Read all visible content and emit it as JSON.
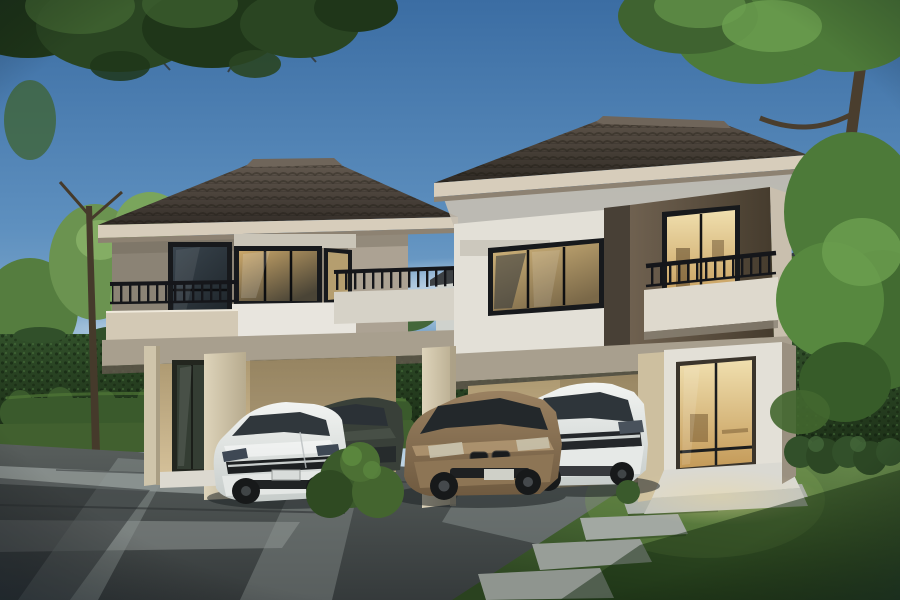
{
  "scene": {
    "type": "architectural-rendering",
    "description": "Dusk 3D rendering of a pair of modern two-storey townhouses with dark tiled hip roofs and warm lit interiors; four cars are parked under the carports; clipped hedge walls, lawn with stepping stones and a paved driveway in front; overhanging tree canopies frame the top corners",
    "time_of_day": "dusk",
    "houses": [
      {
        "name": "left-house",
        "storeys": 2,
        "roof": "hip roof, dark brown tiles, cream fascia",
        "walls": "taupe upper walls with white spandrel band, beige carport wall",
        "features": [
          "tall dark corner window",
          "lit corner window",
          "black metal balcony railing",
          "cream balcony base",
          "carport with cream pillars",
          "ground-floor glass door"
        ]
      },
      {
        "name": "right-house",
        "storeys": 2,
        "roof": "hip roof, dark brown tiles, cream fascia",
        "walls": "white left section, dark brown right section",
        "features": [
          "large black-framed picture window",
          "lit balcony door with black railing",
          "white balcony base",
          "lit entrance sliding glass door",
          "white entrance portal with steps",
          "carport with cream pillar"
        ]
      }
    ],
    "cars": [
      {
        "name": "white-sedan",
        "color_name": "white",
        "hex": "#f2f4f2"
      },
      {
        "name": "dark-gray-sedan",
        "color_name": "dark gray-green",
        "hex": "#394039"
      },
      {
        "name": "bronze-sedan",
        "color_name": "bronze brown",
        "hex": "#9a8161"
      },
      {
        "name": "white-suv",
        "color_name": "white",
        "hex": "#f2f4f2"
      }
    ],
    "landscape": [
      "overhanging dark canopy top-left",
      "overhanging bright canopy and trunk top-right",
      "tall light-green trees on the left",
      "tall clipped hedge wall",
      "low trimmed hedge rows",
      "lawn with stepping-stone path to the lit entrance",
      "paved driveway with light concrete strips",
      "round shrub between the cars",
      "distant houses behind the greenery"
    ]
  },
  "palette": {
    "sky_top": "#3b6da3",
    "sky_mid": "#5e90bf",
    "sky_low": "#8fb5d3",
    "sky_horizon": "#d9e5ed",
    "roof_dark": "#332d28",
    "roof_lit": "#645a50",
    "roof_ridge": "#6f655a",
    "fascia": "#d7cdbb",
    "soffit": "#c6bfb1",
    "soffit_shade": "#8d8272",
    "wall_taupe": "#8b8375",
    "wall_taupe_light": "#aca293",
    "wall_white": "#e3e0d7",
    "wall_brown": "#6f6150",
    "wall_brown_dark": "#453b2d",
    "divider_brown": "#484036",
    "trim_light": "#c9bfae",
    "band_white": "#e8e5de",
    "slab": "#a89f8e",
    "slab_shadow": "#5f574b",
    "carport_wall_top": "#ac9870",
    "carport_wall": "#d6c29b",
    "pillar_light": "#ded4bb",
    "pillar_shade": "#b7ab8e",
    "pillar_beige": "#cdbf9f",
    "window_frame": "#17191c",
    "glass_warm": "#caa76a",
    "glass_bright": "#f0dfae",
    "door_amber": "#c49a58",
    "railing": "#15161a",
    "hedge_top": "#31502a",
    "hedge_bottom": "#1c2f17",
    "low_hedge": "#3a5a2c",
    "low_hedge_light": "#527a38",
    "grass": "#41602f",
    "lawn_lit": "#648549",
    "lawn_dark": "#2a421f",
    "pavement_light": "#585e5c",
    "pavement_dark": "#353a3b",
    "concrete": "#8f9694",
    "stone": "#aab0aa",
    "trunk": "#453a2b",
    "leaf_dark": "#2a4522",
    "leaf_shadow": "#1f3619",
    "leaf_mid": "#3f6330",
    "leaf_bright": "#4d7a39",
    "leaf_light": "#6da050",
    "car_white": "#f2f4f2",
    "car_white_shade": "#c6ccca",
    "car_dark": "#394039",
    "car_bronze": "#9a8161",
    "car_bronze_dark": "#6f5a40",
    "tire": "#17191a",
    "glass_car": "#2b3136",
    "plinth": "#dcd9d0",
    "glow_warm": "#ecd9a0",
    "vignette": "#0a1622"
  }
}
